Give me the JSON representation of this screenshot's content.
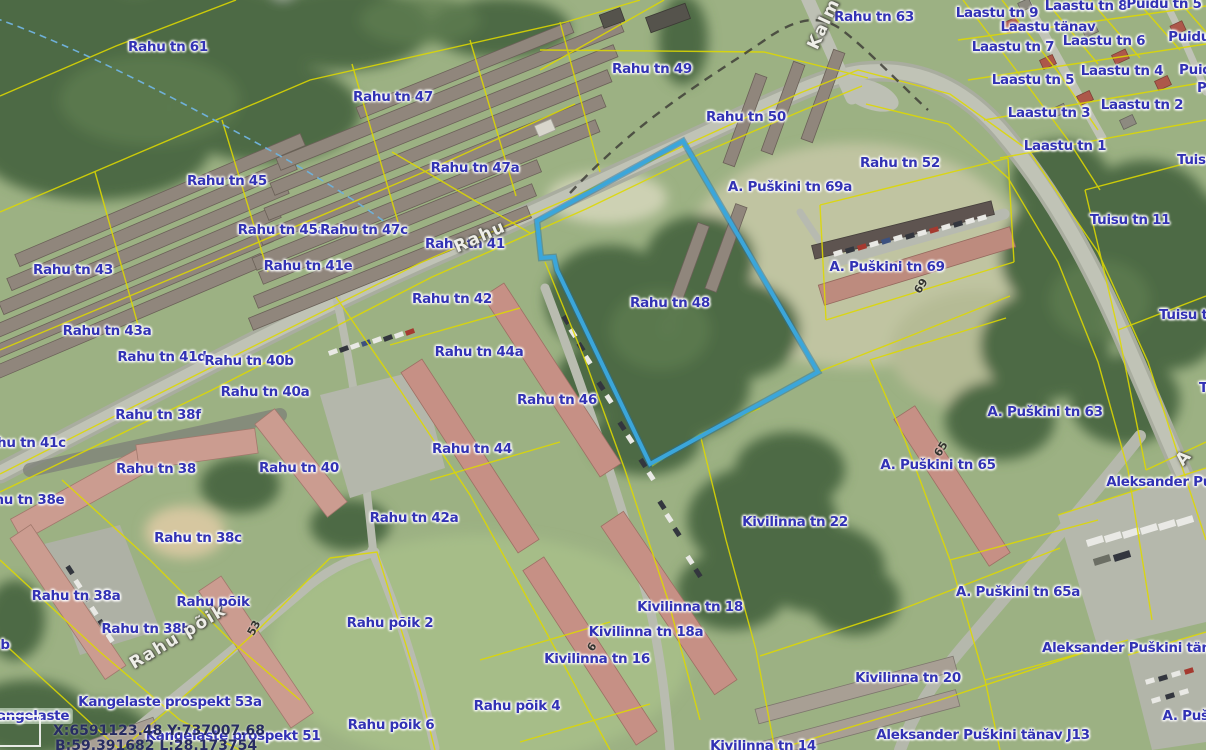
{
  "map": {
    "highlight": {
      "parcel_address": "Rahu tn 48",
      "outline_color": "#3ba6da"
    },
    "cadastral_line_color": "#ded900",
    "label_color": "#3232b4",
    "coordinate_readout": {
      "projected": "X:6591123.48 Y:737007.68",
      "geographic": "B:59.391682 L:28.173754"
    },
    "address_labels": [
      {
        "t": "Rahu tn 61",
        "x": 168,
        "y": 47
      },
      {
        "t": "Rahu tn 63",
        "x": 874,
        "y": 17
      },
      {
        "t": "Laastu tn 9",
        "x": 997,
        "y": 13
      },
      {
        "t": "Laastu tn 8",
        "x": 1086,
        "y": 6
      },
      {
        "t": "Puidu tn 5",
        "x": 1164,
        "y": 4
      },
      {
        "t": "Laastu tänav",
        "x": 1048,
        "y": 27
      },
      {
        "t": "Laastu tn 7",
        "x": 1013,
        "y": 47
      },
      {
        "t": "Laastu tn 6",
        "x": 1104,
        "y": 41
      },
      {
        "t": "Puidu tn",
        "x": 1199,
        "y": 37
      },
      {
        "t": "Rahu tn 47",
        "x": 393,
        "y": 97
      },
      {
        "t": "Rahu tn 49",
        "x": 652,
        "y": 69
      },
      {
        "t": "Laastu tn 5",
        "x": 1033,
        "y": 80
      },
      {
        "t": "Laastu tn 4",
        "x": 1122,
        "y": 71
      },
      {
        "t": "Puidu",
        "x": 1200,
        "y": 70
      },
      {
        "t": "Pi",
        "x": 1204,
        "y": 88
      },
      {
        "t": "Laastu tn 3",
        "x": 1049,
        "y": 113
      },
      {
        "t": "Laastu tn 2",
        "x": 1142,
        "y": 105
      },
      {
        "t": "Rahu tn 50",
        "x": 746,
        "y": 117
      },
      {
        "t": "Laastu tn 1",
        "x": 1065,
        "y": 146
      },
      {
        "t": "Rahu tn 47a",
        "x": 475,
        "y": 168
      },
      {
        "t": "Rahu tn 52",
        "x": 900,
        "y": 163
      },
      {
        "t": "A. Puškini tn 69a",
        "x": 790,
        "y": 187
      },
      {
        "t": "Tuisu",
        "x": 1196,
        "y": 160
      },
      {
        "t": "Rahu tn 45",
        "x": 227,
        "y": 181
      },
      {
        "t": "Rahu tn 45a",
        "x": 282,
        "y": 230
      },
      {
        "t": "Rahu tn 47c",
        "x": 364,
        "y": 230
      },
      {
        "t": "Rahu tn 41",
        "x": 465,
        "y": 244
      },
      {
        "t": "Tuisu tn 11",
        "x": 1130,
        "y": 220
      },
      {
        "t": "Rahu tn 43",
        "x": 73,
        "y": 270
      },
      {
        "t": "Rahu tn 41e",
        "x": 308,
        "y": 266
      },
      {
        "t": "A. Puškini tn 69",
        "x": 887,
        "y": 267
      },
      {
        "t": "Rahu tn 42",
        "x": 452,
        "y": 299
      },
      {
        "t": "Rahu tn 48",
        "x": 670,
        "y": 303
      },
      {
        "t": "Tuisu tn",
        "x": 1188,
        "y": 315
      },
      {
        "t": "Rahu tn 43a",
        "x": 107,
        "y": 331
      },
      {
        "t": "Rahu tn 41d",
        "x": 162,
        "y": 357
      },
      {
        "t": "Rahu tn 40b",
        "x": 249,
        "y": 361
      },
      {
        "t": "Rahu tn 44a",
        "x": 479,
        "y": 352
      },
      {
        "t": "Rahu tn 40a",
        "x": 265,
        "y": 392
      },
      {
        "t": "Tuisu",
        "x": 1218,
        "y": 388
      },
      {
        "t": "A. Puškini tn 63",
        "x": 1045,
        "y": 412
      },
      {
        "t": "Rahu tn 38f",
        "x": 158,
        "y": 415
      },
      {
        "t": "Rahu tn 46",
        "x": 557,
        "y": 400
      },
      {
        "t": "Rahu tn 44",
        "x": 472,
        "y": 449
      },
      {
        "t": "Rahu tn 41c",
        "x": 22,
        "y": 443
      },
      {
        "t": "Rahu tn 38",
        "x": 156,
        "y": 469
      },
      {
        "t": "Rahu tn 40",
        "x": 299,
        "y": 468
      },
      {
        "t": "A. Puškini tn 65",
        "x": 938,
        "y": 465
      },
      {
        "t": "Aleksander Puš",
        "x": 1163,
        "y": 482
      },
      {
        "t": "Rahu tn 38e",
        "x": 20,
        "y": 500
      },
      {
        "t": "Kivilinna tn 22",
        "x": 795,
        "y": 522
      },
      {
        "t": "Rahu tn 42a",
        "x": 414,
        "y": 518
      },
      {
        "t": "Rahu tn 38c",
        "x": 198,
        "y": 538
      },
      {
        "t": "A. Puškini tn 65a",
        "x": 1018,
        "y": 592
      },
      {
        "t": "Rahu tn 38a",
        "x": 76,
        "y": 596
      },
      {
        "t": "Rahu põik",
        "x": 213,
        "y": 602
      },
      {
        "t": "Kivilinna tn 18",
        "x": 690,
        "y": 607
      },
      {
        "t": "Rahu tn 38b",
        "x": 146,
        "y": 629
      },
      {
        "t": "Rahu põik 2",
        "x": 390,
        "y": 623
      },
      {
        "t": "Kivilinna tn 18a",
        "x": 646,
        "y": 632
      },
      {
        "t": "b",
        "x": 5,
        "y": 645
      },
      {
        "t": "Aleksander Puškini tänav",
        "x": 1135,
        "y": 648
      },
      {
        "t": "Kivilinna tn 16",
        "x": 597,
        "y": 659
      },
      {
        "t": "Kivilinna tn 20",
        "x": 908,
        "y": 678
      },
      {
        "t": "Kangelaste prospekt 53a",
        "x": 170,
        "y": 702
      },
      {
        "t": "Rahu põik 4",
        "x": 517,
        "y": 706
      },
      {
        "t": "Rahu põik 6",
        "x": 391,
        "y": 725
      },
      {
        "t": "Kangelaste",
        "x": 28,
        "y": 716,
        "pill": true
      },
      {
        "t": "Kangelaste prospekt 51",
        "x": 233,
        "y": 736
      },
      {
        "t": "Aleksander Puškini tänav J13",
        "x": 983,
        "y": 735
      },
      {
        "t": "A. Pušk",
        "x": 1190,
        "y": 716
      },
      {
        "t": "Kivilinna tn 14",
        "x": 763,
        "y": 746
      }
    ],
    "street_name_labels": [
      {
        "t": "Rahu",
        "x": 480,
        "y": 237,
        "r": -24
      },
      {
        "t": "Rahu põik",
        "x": 178,
        "y": 637,
        "r": -31
      },
      {
        "t": "Kalm",
        "x": 824,
        "y": 24,
        "r": -65
      },
      {
        "t": "A",
        "x": 1184,
        "y": 458,
        "r": -48
      }
    ],
    "building_numbers": [
      {
        "t": "69",
        "x": 921,
        "y": 286,
        "r": -58
      },
      {
        "t": "65",
        "x": 941,
        "y": 449,
        "r": -58
      },
      {
        "t": "53",
        "x": 254,
        "y": 628,
        "r": -62
      },
      {
        "t": "6",
        "x": 592,
        "y": 647,
        "r": -55
      }
    ]
  }
}
